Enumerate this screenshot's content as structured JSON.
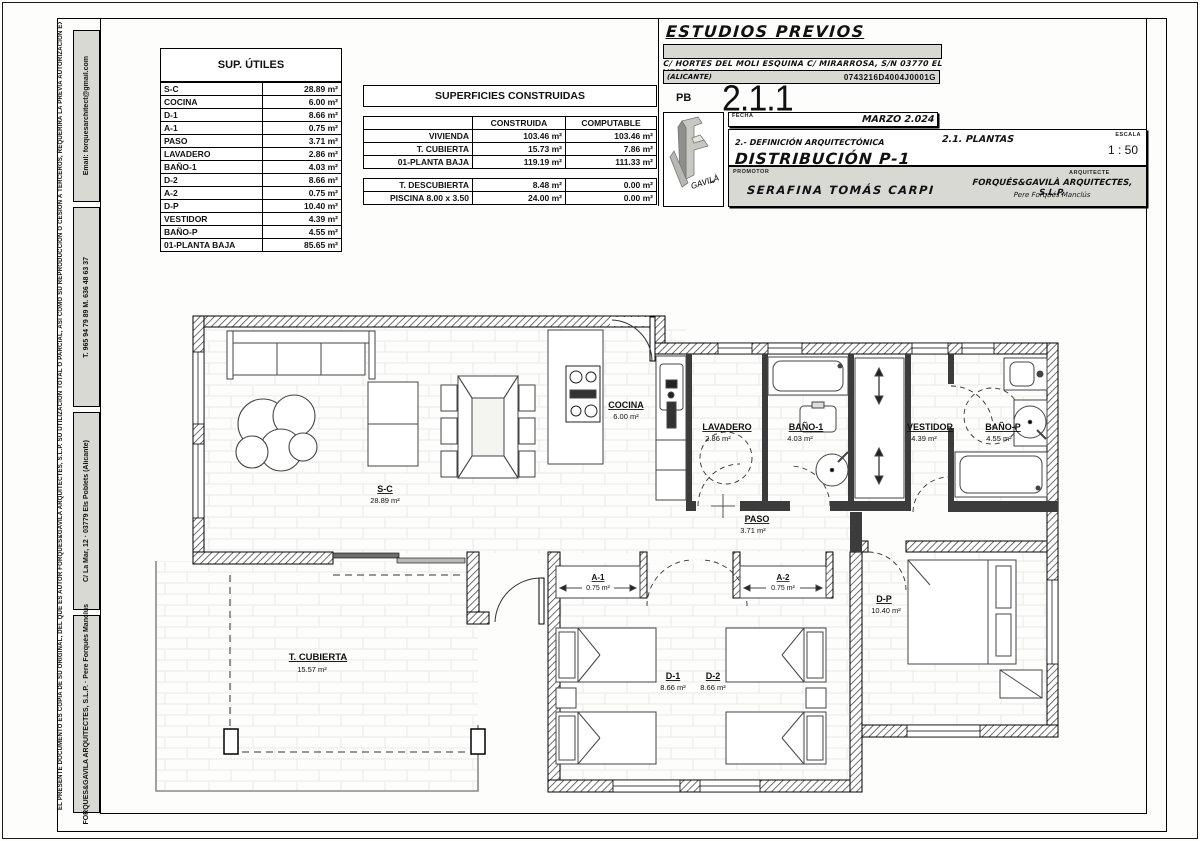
{
  "margin": {
    "copyright_line": "EL PRESENTE DOCUMENTO ES COPIA DE SU ORIGINAL, DEL QUE ES AUTOR FORQUES&GAVILA ARQUITECTES, S.L.P. SU UTILIZACION TOTAL O PARCIAL, ASI COMO SU REPRODUCCION O CESION A TERCEROS, REQUERIRA LA PREVIA AUTORIZACION EXPRESA DE SU AUTOR, QUEDANDO EN TODO CASO PROHIBIDA CUALQUIER MODIFICACION UNILATERAL DEL MISMO",
    "email": "Email:  forquesarchitect@gmail.com",
    "phone": "T. 965 94 79 89   M. 636 48 63 37",
    "address": "C/ La Mar, 12 · 03779 Els Poblets (Alicante)",
    "firm_line": "FORQUES&GAVILA ARQUITECTES, S.L.P.   ·   Pere Forqués Manclús"
  },
  "tables": {
    "utiles": {
      "title": "SUP. ÚTILES",
      "rows": [
        [
          "S-C",
          "28.89 m²"
        ],
        [
          "COCINA",
          "6.00 m²"
        ],
        [
          "D-1",
          "8.66 m²"
        ],
        [
          "A-1",
          "0.75 m²"
        ],
        [
          "PASO",
          "3.71 m²"
        ],
        [
          "LAVADERO",
          "2.86 m²"
        ],
        [
          "BAÑO-1",
          "4.03 m²"
        ],
        [
          "D-2",
          "8.66 m²"
        ],
        [
          "A-2",
          "0.75 m²"
        ],
        [
          "D-P",
          "10.40 m²"
        ],
        [
          "VESTIDOR",
          "4.39 m²"
        ],
        [
          "BAÑO-P",
          "4.55 m²"
        ],
        [
          "01-PLANTA BAJA",
          "85.65 m²"
        ]
      ]
    },
    "construidas": {
      "title": "SUPERFICIES CONSTRUIDAS",
      "col_headers": [
        "CONSTRUIDA",
        "COMPUTABLE"
      ],
      "rows": [
        [
          "VIVIENDA",
          "103.46 m²",
          "103.46 m²"
        ],
        [
          "T. CUBIERTA",
          "15.73 m²",
          "7.86 m²"
        ],
        [
          "01-PLANTA BAJA",
          "119.19 m²",
          "111.33 m²"
        ]
      ],
      "rows2": [
        [
          "T. DESCUBIERTA",
          "8.48 m²",
          "0.00 m²"
        ],
        [
          "PISCINA  8.00 x 3.50",
          "24.00 m²",
          "0.00 m²"
        ]
      ]
    }
  },
  "titleblock": {
    "project_type": "ESTUDIOS PREVIOS",
    "address_line": "C/ HORTES DEL MOLI ESQUINA C/ MIRARROSA, S/N 03770 EL VERGER",
    "municipality": "(ALICANTE)",
    "cadastral_ref": "0743216D4004J0001G",
    "floor_code": "PB",
    "sheet_number": "2.1.1",
    "fecha_label": "FECHA",
    "date": "MARZO 2.024",
    "section_title": "2.- DEFINICIÓN ARQUITECTÓNICA",
    "drawing_title": "DISTRIBUCIÓN P-1",
    "subsection": "2.1. PLANTAS",
    "escala_label": "ESCALA",
    "scale": "1 : 50",
    "promotor_label": "PROMOTOR",
    "promotor": "SERAFINA TOMÁS CARPI",
    "arquitecto_label": "ARQUITECTE",
    "firm": "FORQUÉS&GAVILÀ ARQUITECTES, S.L.P.",
    "architect": "Pere Forqués Manclús",
    "logo_text": "GAVILÀ"
  },
  "plan": {
    "rooms": [
      {
        "label": "S-C",
        "area": "28.89 m²"
      },
      {
        "label": "COCINA",
        "area": "6.00 m²"
      },
      {
        "label": "LAVADERO",
        "area": "2.86 m²"
      },
      {
        "label": "BAÑO-1",
        "area": "4.03 m²"
      },
      {
        "label": "VESTIDOR",
        "area": "4.39 m²"
      },
      {
        "label": "BAÑO-P",
        "area": "4.55 m²"
      },
      {
        "label": "PASO",
        "area": "3.71 m²"
      },
      {
        "label": "A-1",
        "area": "0.75 m²"
      },
      {
        "label": "A-2",
        "area": "0.75 m²"
      },
      {
        "label": "D-1",
        "area": "8.66 m²"
      },
      {
        "label": "D-2",
        "area": "8.66 m²"
      },
      {
        "label": "D-P",
        "area": "10.40 m²"
      },
      {
        "label": "T. CUBIERTA",
        "area": "15.57 m²"
      }
    ]
  }
}
